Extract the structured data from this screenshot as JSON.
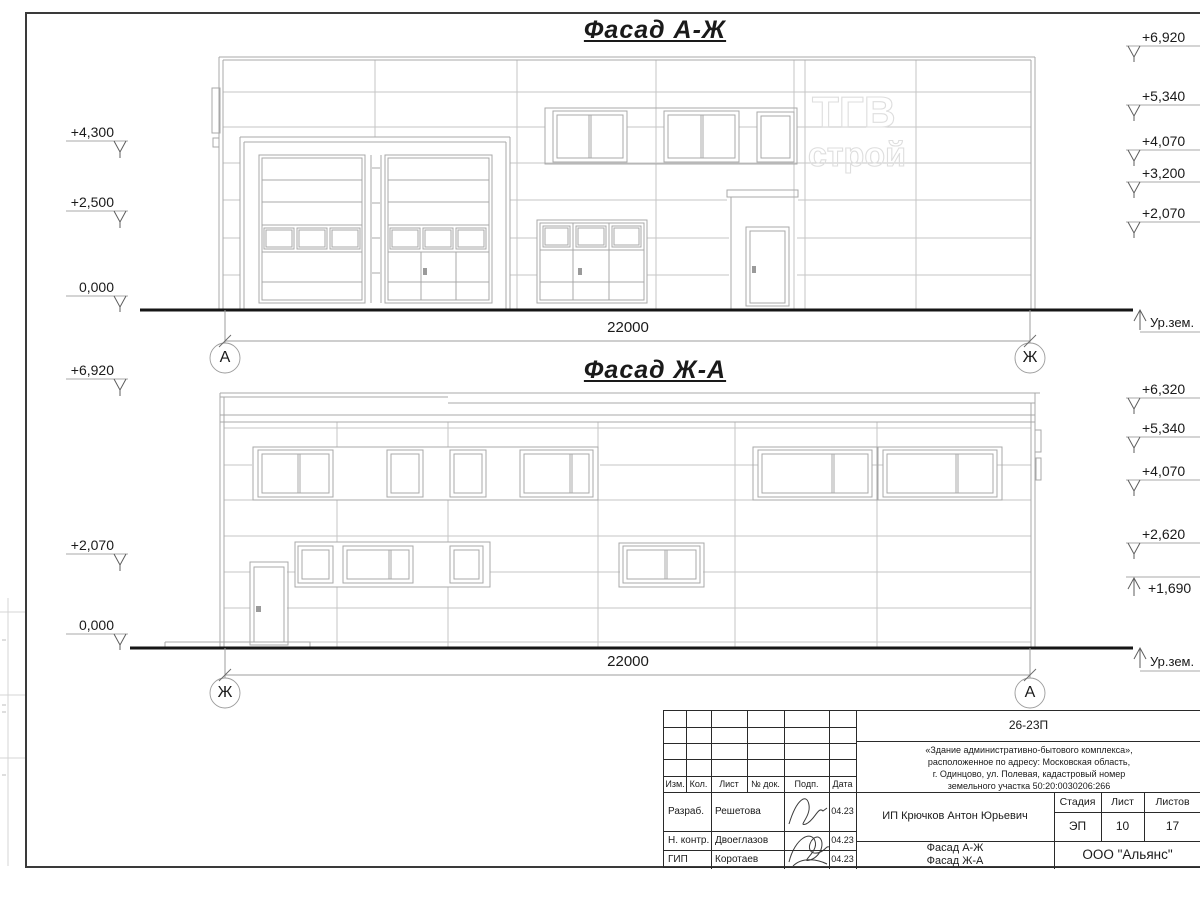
{
  "watermark": {
    "line1": "ТГВ",
    "line2": "строй"
  },
  "facade_top": {
    "title": "Фасад А-Ж",
    "dimension_mm": "22000",
    "axis_left": "А",
    "axis_right": "Ж",
    "ground_label": "Ур.зем.",
    "elevations_left": [
      "+4,300",
      "+2,500",
      "0,000"
    ],
    "elevations_right": [
      "+6,920",
      "+5,340",
      "+4,070",
      "+3,200",
      "+2,070"
    ]
  },
  "facade_bottom": {
    "title": "Фасад Ж-А",
    "dimension_mm": "22000",
    "axis_left": "Ж",
    "axis_right": "А",
    "ground_label": "Ур.зем.",
    "elevations_left": [
      "+6,920",
      "+2,070",
      "0,000"
    ],
    "elevations_right": [
      "+6,320",
      "+5,340",
      "+4,070",
      "+2,620",
      "+1,690"
    ]
  },
  "title_block": {
    "doc_code": "26-23П",
    "project_lines": [
      "«Здание административно-бытового комплекса»,",
      "расположенное по адресу: Московская область,",
      "г. Одинцово, ул. Полевая, кадастровый номер",
      "земельного участка 50:20:0030206:266"
    ],
    "client": "ИП Крючков Антон Юрьевич",
    "drawing_title_line1": "Фасад А-Ж",
    "drawing_title_line2": "Фасад Ж-А",
    "organization": "ООО \"Альянс\"",
    "header_cols": [
      "Изм.",
      "Кол.",
      "Лист",
      "№ док.",
      "Подп.",
      "Дата"
    ],
    "stage_cols": [
      "Стадия",
      "Лист",
      "Листов"
    ],
    "stage_values": [
      "ЭП",
      "10",
      "17"
    ],
    "signature_rows": [
      {
        "role": "Разраб.",
        "name": "Решетова",
        "date": "04.23"
      },
      {
        "role": "Н. контр.",
        "name": "Двоеглазов",
        "date": "04.23"
      },
      {
        "role": "ГИП",
        "name": "Коротаев",
        "date": "04.23"
      }
    ]
  },
  "colors": {
    "ink": "#1a1a1a",
    "drawing_line": "#b9b9b9",
    "watermark": "#dedede"
  }
}
